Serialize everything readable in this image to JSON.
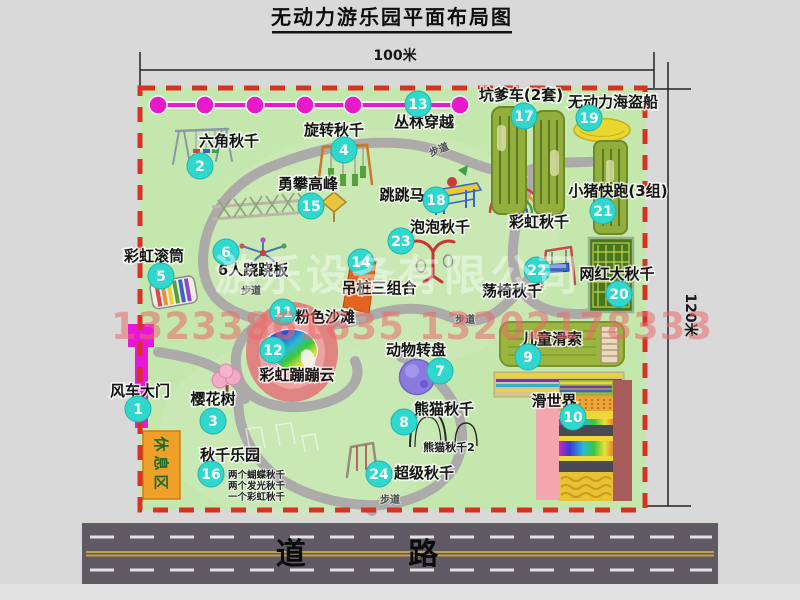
{
  "title": "无动力游乐园平面布局图",
  "dimensions": {
    "width": "100米",
    "height": "120米"
  },
  "road_label": "道 路",
  "path_label": "步道",
  "rest_area_label": "休息区",
  "watermark": {
    "company": "游乐设备有限公司",
    "phone": "13233861635 13202178333"
  },
  "items": [
    {
      "num": "1",
      "label": "风车大门"
    },
    {
      "num": "2",
      "label": "六角秋千"
    },
    {
      "num": "3",
      "label": "樱花树"
    },
    {
      "num": "4",
      "label": "旋转秋千"
    },
    {
      "num": "5",
      "label": "彩虹滚筒"
    },
    {
      "num": "6",
      "label": "6人跷跷板"
    },
    {
      "num": "7",
      "label": "动物转盘"
    },
    {
      "num": "8",
      "label": "熊猫秋千"
    },
    {
      "num": "9",
      "label": "儿童滑索"
    },
    {
      "num": "10",
      "label": "滑世界"
    },
    {
      "num": "11",
      "label": "粉色沙滩"
    },
    {
      "num": "12",
      "label": "彩虹蹦蹦云"
    },
    {
      "num": "13",
      "label": "丛林穿越"
    },
    {
      "num": "14",
      "label": "吊桩三组合"
    },
    {
      "num": "15",
      "label": "勇攀高峰"
    },
    {
      "num": "16",
      "label": "秋千乐园"
    },
    {
      "num": "17",
      "label": "坑爹车(2套)"
    },
    {
      "num": "18",
      "label": "跳跳马"
    },
    {
      "num": "19",
      "label": "无动力海盗船"
    },
    {
      "num": "20",
      "label": "网红大秋千"
    },
    {
      "num": "21",
      "label": "小猪快跑(3组)"
    },
    {
      "num": "22",
      "label": "荡椅秋千"
    },
    {
      "num": "23",
      "label": "泡泡秋千"
    },
    {
      "num": "24",
      "label": "超级秋千"
    }
  ],
  "extra_labels": {
    "rainbow_swing": "彩虹秋千",
    "panda_swing_2": "熊猫秋千2"
  },
  "swing_park_notes": [
    "两个蝴蝶秋千",
    "两个发光秋千",
    "一个彩虹秋千"
  ],
  "colors": {
    "map_green": "#c4e7ae",
    "border_red": "#d73222",
    "badge_teal": "#2fd7cd",
    "zipline_magenta": "#e719cb",
    "gate_magenta": "#e816d8",
    "rest_area_orange": "#f0a028",
    "road_gray": "#5f5a64",
    "equipment_olive": "#92ae3c",
    "watermark_pink": "#e96a6a"
  }
}
